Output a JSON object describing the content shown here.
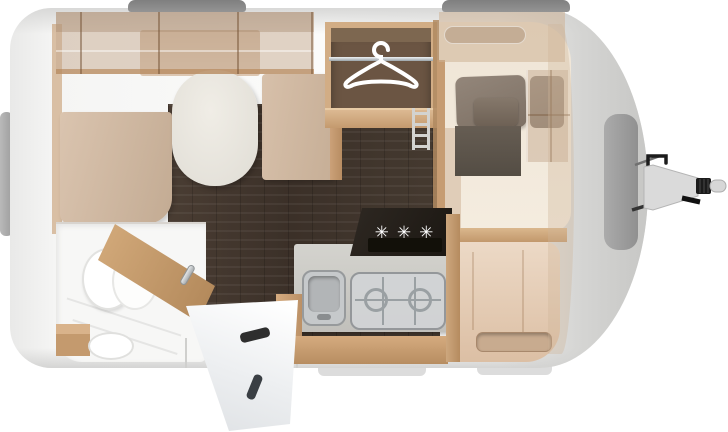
{
  "scene": {
    "type": "caravan-floorplan-top-view",
    "background": "#ffffff"
  },
  "labels": {
    "burner_symbols": "✳✳✳"
  },
  "icons": [
    {
      "name": "hanger-icon",
      "meaning": "wardrobe with clothes rail"
    },
    {
      "name": "burner-symbols",
      "meaning": "three-burner gas hob"
    }
  ],
  "palette": {
    "body_shell": "#f2f2f1",
    "shell_shadow": "#d7d7d6",
    "roof_vent": "#8b8b8b",
    "front_window": "#9e9e9e",
    "wood_trim": "#c49a6e",
    "furniture_beige": "#d2bba4",
    "overlay_beige": "rgba(198,170,144,0.5)",
    "floor_wood_dark": "#42372d",
    "wardrobe_interior": "#6b5543",
    "mattress_cream": "#f1e9dc",
    "pillow_taupe": "#8a7d70",
    "blanket_gray": "#575047",
    "counter_gray": "#c9c8c3",
    "hob_glass_black": "#221d18",
    "steel_gray": "#c6c9cb",
    "bathroom_white": "#f7f7f6",
    "hitch_gray": "#d9d9d9",
    "hitch_black": "#1b1b1b"
  },
  "regions": [
    "dinette-lounge",
    "wardrobe",
    "front-bed",
    "kitchen",
    "entry",
    "bathroom",
    "drawbar-hitch"
  ]
}
